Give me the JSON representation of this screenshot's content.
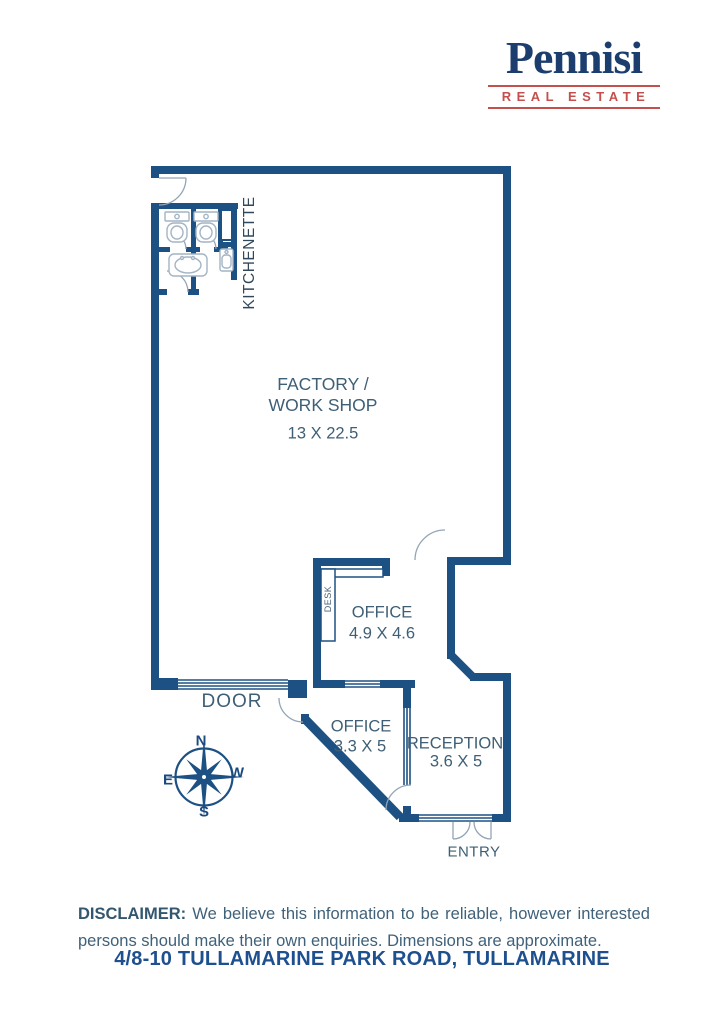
{
  "logo": {
    "brand": "Pennisi",
    "tagline": "REAL ESTATE"
  },
  "rooms": {
    "factory": {
      "line1": "FACTORY /",
      "line2": "WORK SHOP",
      "dims": "13 X 22.5"
    },
    "office_top": {
      "name": "OFFICE",
      "dims": "4.9 X 4.6"
    },
    "office_lower": {
      "name": "OFFICE",
      "dims": "3.3 X 5"
    },
    "reception": {
      "name": "RECEPTION",
      "dims": "3.6 X 5"
    }
  },
  "labels": {
    "kitchenette": "KITCHENETTE",
    "desk": "DESK",
    "door": "DOOR",
    "entry": "ENTRY"
  },
  "compass": {
    "n": "N",
    "e": "E",
    "s": "S",
    "w": "W"
  },
  "disclaimer": {
    "heading": "DISCLAIMER:",
    "body": " We believe this information to be reliable, however interested persons should make their own enquiries. Dimensions are approximate."
  },
  "address": "4/8-10 TULLAMARINE PARK ROAD, TULLAMARINE",
  "colors": {
    "wall_blue": "#1d5183",
    "accent_red": "#c4504d",
    "brand_navy": "#1c3e6e",
    "label_slate": "#3e5f76",
    "address_blue": "#1e4f8f",
    "fixture_gray": "#a3b4c4"
  }
}
